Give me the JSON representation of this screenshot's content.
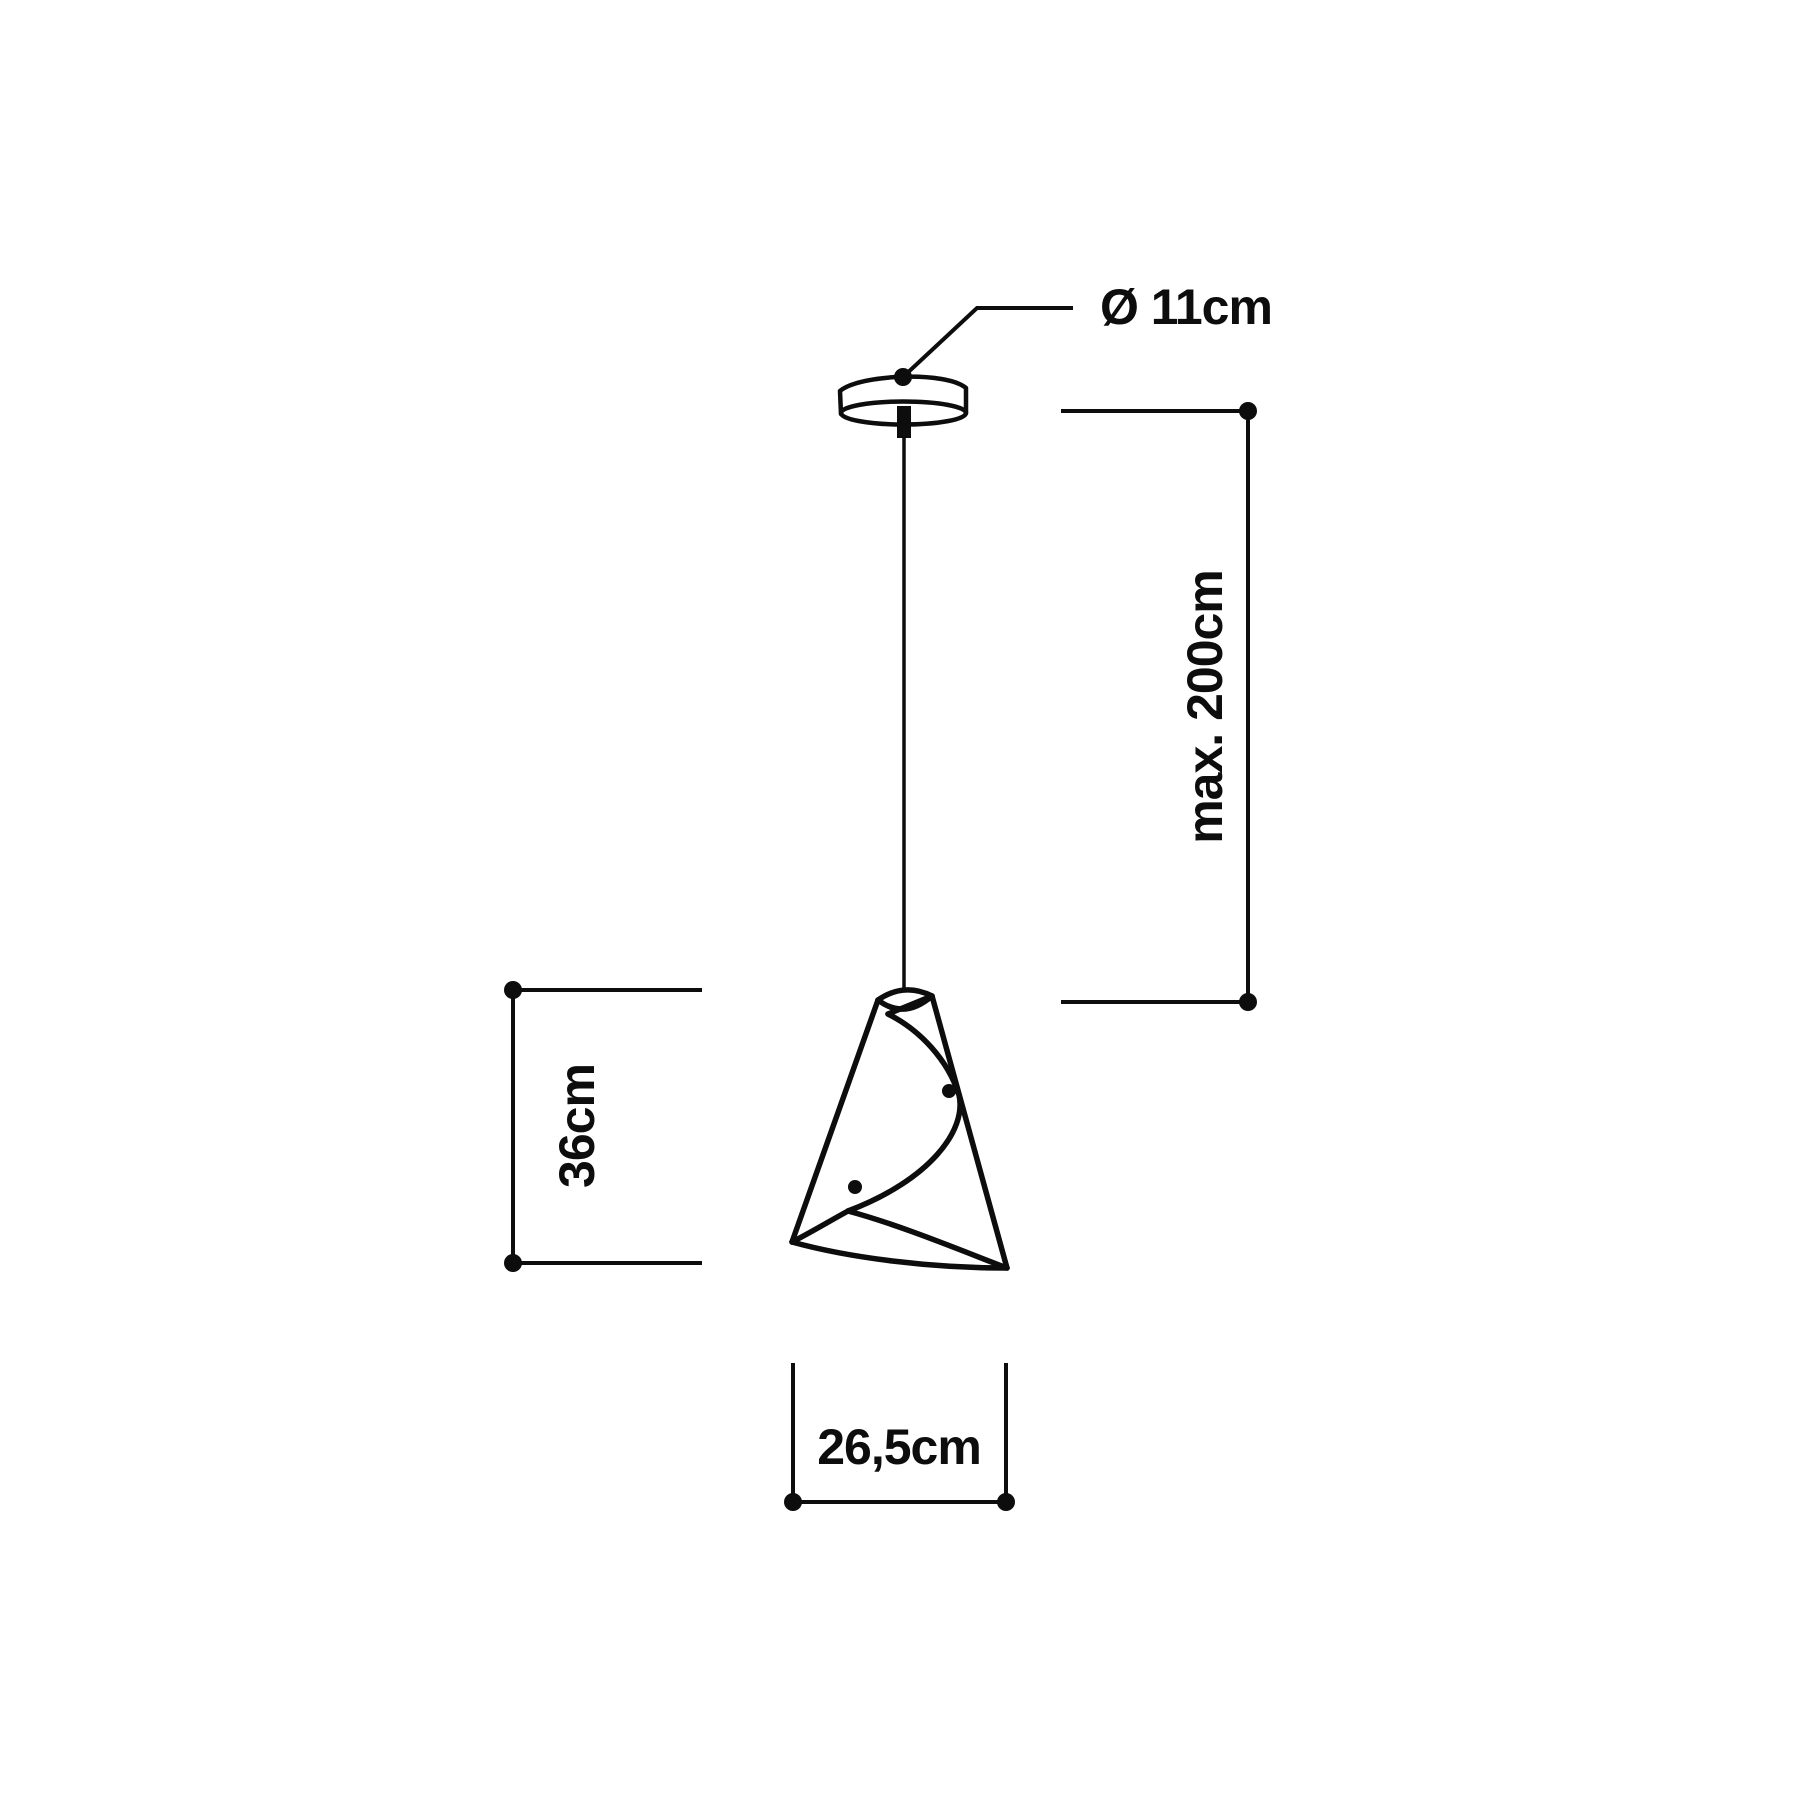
{
  "diagram": {
    "background_color": "#ffffff",
    "line_color": "#0d0d0d",
    "labels": {
      "canopy_diameter": "Ø 11cm",
      "suspension_max_length": "max. 200cm",
      "shade_height": "36cm",
      "shade_width": "26,5cm"
    }
  }
}
